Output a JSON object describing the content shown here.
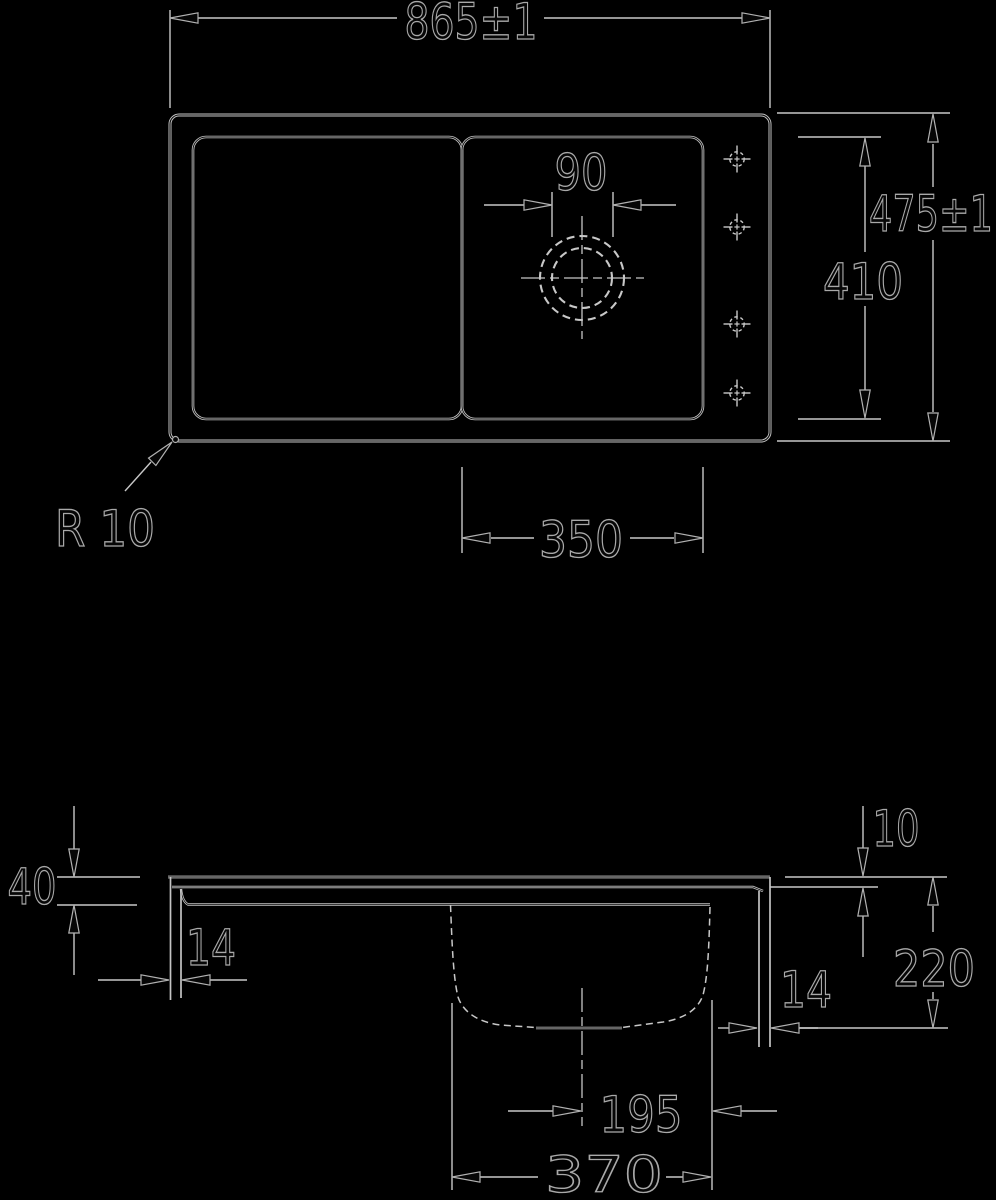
{
  "drawing": {
    "top_view": {
      "width_label": "865±1",
      "height_label": "475±1",
      "inner_height_label": "410",
      "bowl_width_label": "350",
      "drain_diameter_label": "90",
      "corner_radius_label": "R 10"
    },
    "section_view": {
      "drainer_depth_label": "40",
      "left_wall_label": "14",
      "rim_thickness_label": "10",
      "bowl_depth_label": "220",
      "right_wall_label": "14",
      "drain_offset_label": "195",
      "bowl_bottom_label": "370"
    },
    "colors": {
      "background": "#000000",
      "line": "#c8c8c8",
      "text_outline": "#a9a9a9",
      "text_fill": "#060606"
    }
  }
}
